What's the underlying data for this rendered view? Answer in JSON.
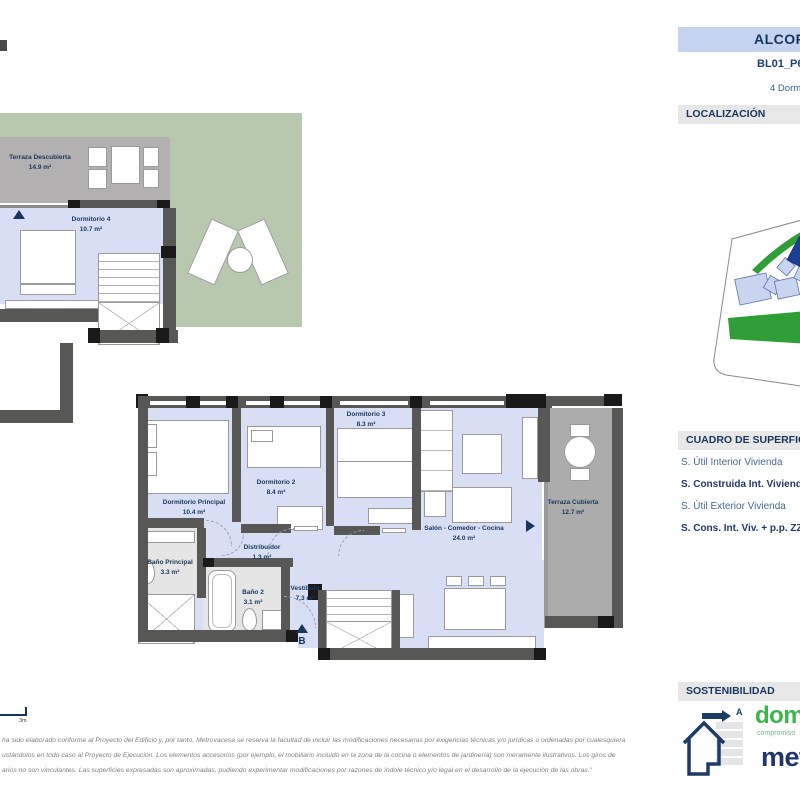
{
  "colors": {
    "accent_navy": "#17365d",
    "room_fill": "#d8dff4",
    "wall_gray": "#575756",
    "terrace_gray": "#acacac",
    "garden_green": "#b7c8af",
    "title_bar_bg": "#c6d3f0",
    "section_header_bg": "#e8e7e7",
    "map_green": "#2f9e36",
    "map_block_blue": "#c9d4ef",
    "map_block_highlight": "#1c3f96",
    "logo_green": "#3db54a",
    "logo_blue": "#21356b"
  },
  "header": {
    "title": "ALCOR",
    "plan_code": "BL01_P6",
    "subtitle": "4 Dormitorios"
  },
  "section_headers": {
    "localizacion": "LOCALIZACIÓN",
    "superficies": "CUADRO DE SUPERFICIES",
    "sostenibilidad": "SOSTENIBILIDAD"
  },
  "surface_table": {
    "rows": [
      {
        "label": "S. Útil Interior Vivienda",
        "bold": false
      },
      {
        "label": "S. Construida Int. Vivienda",
        "bold": true
      },
      {
        "label": "S. Útil Exterior Vivienda",
        "bold": false
      },
      {
        "label": "S. Cons. Int. Viv. + p.p. ZZCC",
        "bold": true
      }
    ]
  },
  "plan_upper": {
    "rooms": [
      {
        "name": "Terraza Descubierta",
        "area": "14.9 m²"
      },
      {
        "name": "Dormitorio 4",
        "area": "10.7 m²"
      }
    ]
  },
  "plan_main": {
    "rooms": [
      {
        "name": "Dormitorio Principal",
        "area": "10.4 m²"
      },
      {
        "name": "Dormitorio 2",
        "area": "8.4 m²"
      },
      {
        "name": "Dormitorio 3",
        "area": "8.3 m²"
      },
      {
        "name": "Salón - Comedor - Cocina",
        "area": "24.0 m²"
      },
      {
        "name": "Terraza Cubierta",
        "area": "12.7 m²"
      },
      {
        "name": "Distribuidor",
        "area": "1.3 m²"
      },
      {
        "name": "Vestíbulo",
        "area": "7.3 m²"
      },
      {
        "name": "Baño Principal",
        "area": "3.3 m²"
      },
      {
        "name": "Baño 2",
        "area": "3.1 m²"
      }
    ],
    "entrance_label": "B"
  },
  "scale_bar": {
    "label": "3m"
  },
  "sustainability": {
    "energy_rating": "A"
  },
  "logos": {
    "brand_green": "dom",
    "brand_green_sub": "compromiso",
    "brand_blue": "metrovacesa"
  },
  "disclaimer": {
    "lines": [
      "ha sido elaborado conforme al Proyecto del Edificio y, por tanto, Metrovacesa se reserva la facultad de incluir las modificaciones necesarias por exigencias técnicas y/o jurídicas u ordenadas por cualesquiera",
      "ustándolos en todo caso al Proyecto de Ejecución. Los elementos accesorios (por ejemplo, el mobiliario incluido en la zona de la cocina o elementos de jardinería) son meramente ilustrativos. Los giros de",
      "arios no son vinculantes. Las superficies expresadas son aproximadas, pudiendo experimentar modificaciones por razones de índole técnico y/o legal en el desarrollo de la ejecución de las obras.\""
    ]
  }
}
